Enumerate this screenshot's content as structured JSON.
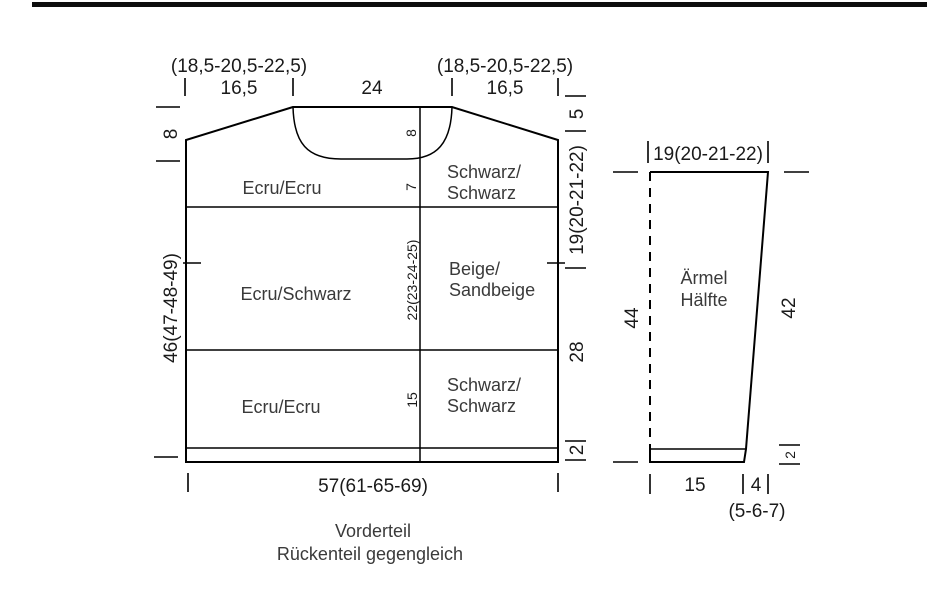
{
  "front": {
    "size_left": "(18,5-20,5-22,5)",
    "shoulder_left": "16,5",
    "neck_width": "24",
    "size_right": "(18,5-20,5-22,5)",
    "shoulder_right": "16,5",
    "left": {
      "shoulder_drop": "8",
      "body_length": "46(47-48-49)"
    },
    "right": {
      "shoulder_drop": "5",
      "armhole_depth": "19(20-21-22)",
      "side_length": "28",
      "rib_height": "2"
    },
    "center": {
      "neck_depth": "8",
      "below_neck": "7",
      "mid_height": "22(23-24-25)",
      "lower_height": "15"
    },
    "bottom_width": "57(61-65-69)",
    "regions": {
      "top_left": "Ecru/Ecru",
      "top_right_1": "Schwarz/",
      "top_right_2": "Schwarz",
      "mid_left": "Ecru/Schwarz",
      "mid_right_1": "Beige/",
      "mid_right_2": "Sandbeige",
      "low_left": "Ecru/Ecru",
      "low_right_1": "Schwarz/",
      "low_right_2": "Schwarz"
    },
    "caption_1": "Vorderteil",
    "caption_2": "Rückenteil gegengleich"
  },
  "sleeve": {
    "top_width": "19(20-21-22)",
    "name_1": "Ärmel",
    "name_2": "Hälfte",
    "length_left": "44",
    "length_right": "42",
    "rib_height": "2",
    "bottom_width": "15",
    "top_offset": "4",
    "top_offset_sizes": "(5-6-7)"
  }
}
